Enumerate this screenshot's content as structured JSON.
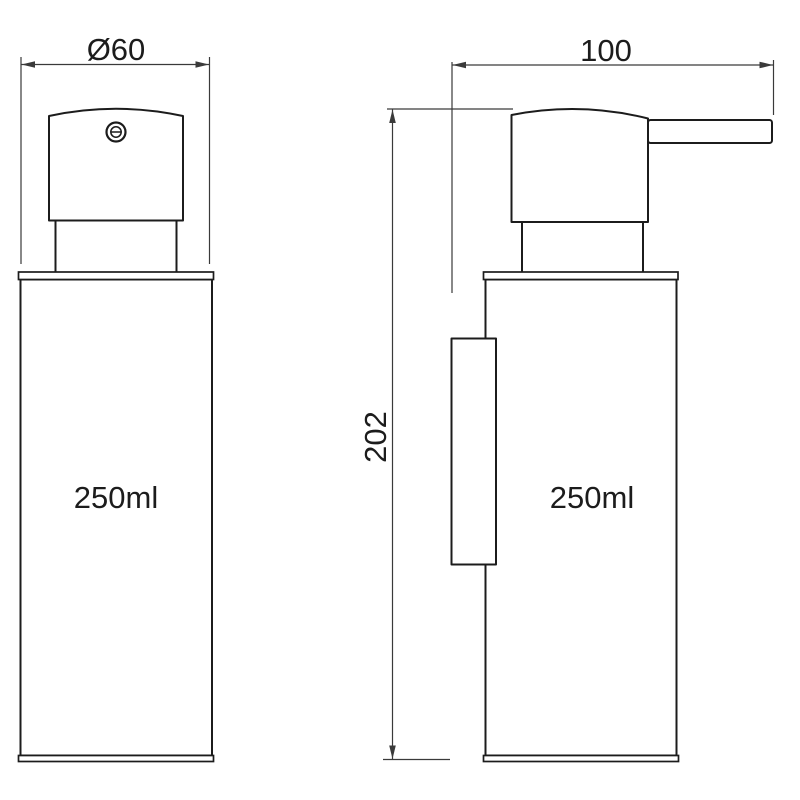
{
  "drawing_labels": {
    "front_view": {
      "diameter_label": "Ø60",
      "volume_label": "250ml"
    },
    "side_view": {
      "width_label": "100",
      "height_label": "202",
      "volume_label": "250ml"
    }
  },
  "colors": {
    "line": "#1c1c1c",
    "dim": "#3a3a3a",
    "background": "#ffffff"
  }
}
